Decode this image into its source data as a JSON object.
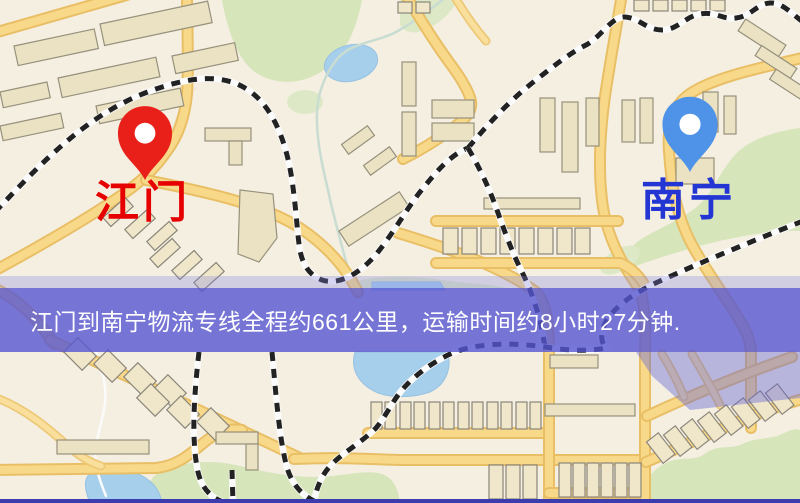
{
  "map": {
    "markers": {
      "origin": {
        "label": "江门",
        "pin_color": "#e9201a",
        "label_color": "#e60000"
      },
      "destination": {
        "label": "南宁",
        "pin_color": "#4f93e8",
        "label_color": "#2336d4"
      }
    }
  },
  "banner": {
    "text": "江门到南宁物流专线全程约661公里，运输时间约8小时27分钟.",
    "background_color": "#5656d2",
    "text_color": "#ffffff"
  },
  "footer": {
    "strip_color": "#3c3cae"
  }
}
